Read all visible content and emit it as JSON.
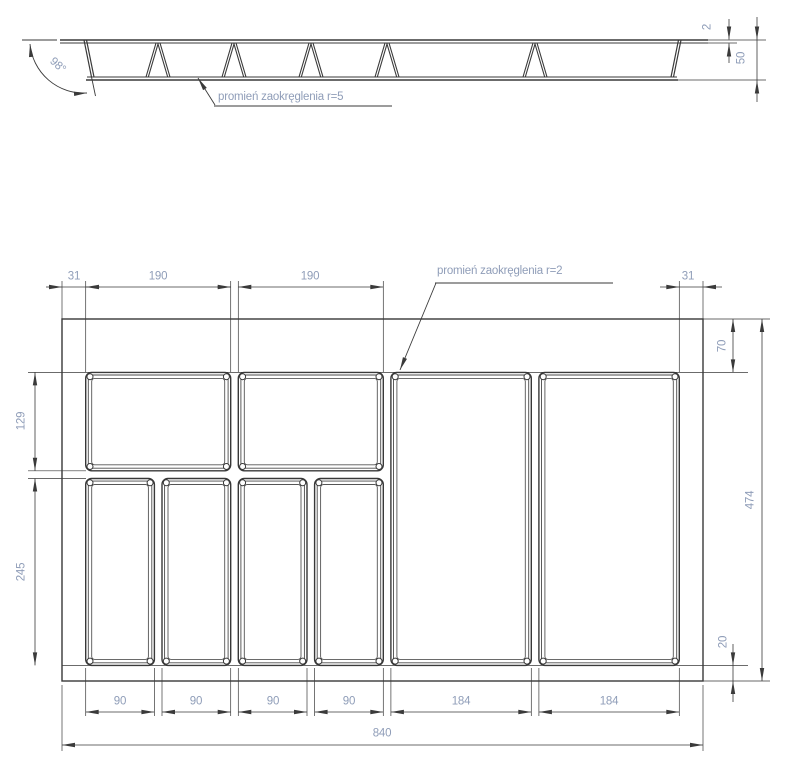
{
  "drawing": {
    "title": "Rysunek techniczny wkładu na sztućce",
    "colors": {
      "line": "#3a3a3a",
      "dim_text": "#8f9db8",
      "background": "#ffffff"
    },
    "section_view": {
      "angle": "98°",
      "rim_thickness": "2",
      "height": "50",
      "fillet_note": "promień zaokręglenia r=5"
    },
    "plan_view": {
      "fillet_note": "promień zaokręglenia r=2",
      "margin_left": "31",
      "top_compartment_1": "190",
      "top_compartment_2": "190",
      "margin_right": "31",
      "offset_top": "70",
      "row1_height": "129",
      "row2_height": "245",
      "inner_height": "474",
      "offset_bottom": "20",
      "small_compartments": [
        "90",
        "90",
        "90",
        "90"
      ],
      "large_compartments": [
        "184",
        "184"
      ],
      "total_width": "840"
    }
  }
}
